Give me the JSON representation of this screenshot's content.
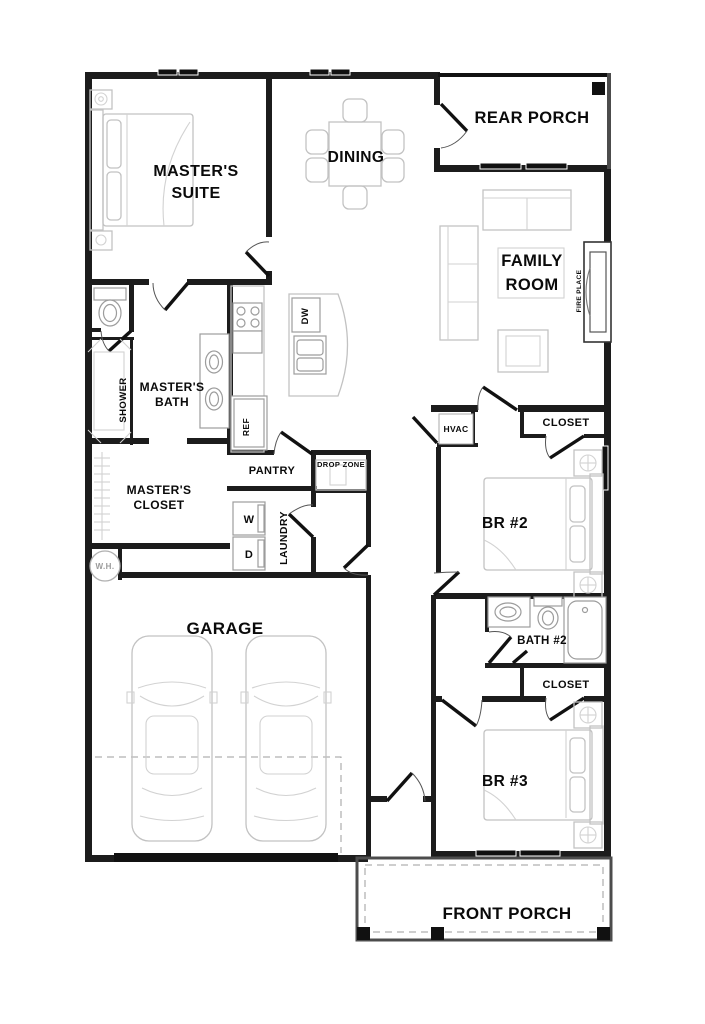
{
  "plan": {
    "title": "single-story house floor plan",
    "labels": {
      "master_suite_1": "MASTER'S",
      "master_suite_2": "SUITE",
      "dining": "DINING",
      "rear_porch": "REAR PORCH",
      "family_room_1": "FAMILY",
      "family_room_2": "ROOM",
      "fireplace": "FIRE PLACE",
      "masters_bath_1": "MASTER'S",
      "masters_bath_2": "BATH",
      "shower": "SHOWER",
      "ref": "REF",
      "dw": "DW",
      "pantry": "PANTRY",
      "drop_zone": "DROP ZONE",
      "masters_closet_1": "MASTER'S",
      "masters_closet_2": "CLOSET",
      "washer": "W",
      "dryer": "D",
      "laundry": "LAUNDRY",
      "water_heater": "W.H.",
      "hvac": "HVAC",
      "closet_br2": "CLOSET",
      "br2": "BR #2",
      "bath2": "BATH #2",
      "closet_br3": "CLOSET",
      "br3": "BR #3",
      "garage": "GARAGE",
      "front_porch": "FRONT PORCH"
    },
    "colors": {
      "wall": "#1c1c1c",
      "porch_wall": "#4c4c4c",
      "furniture": "#c2c2c2",
      "fixture": "#9c9c9c",
      "text": "#0a0a0a",
      "muted_text": "#9a9a9a",
      "background": "#ffffff"
    }
  }
}
